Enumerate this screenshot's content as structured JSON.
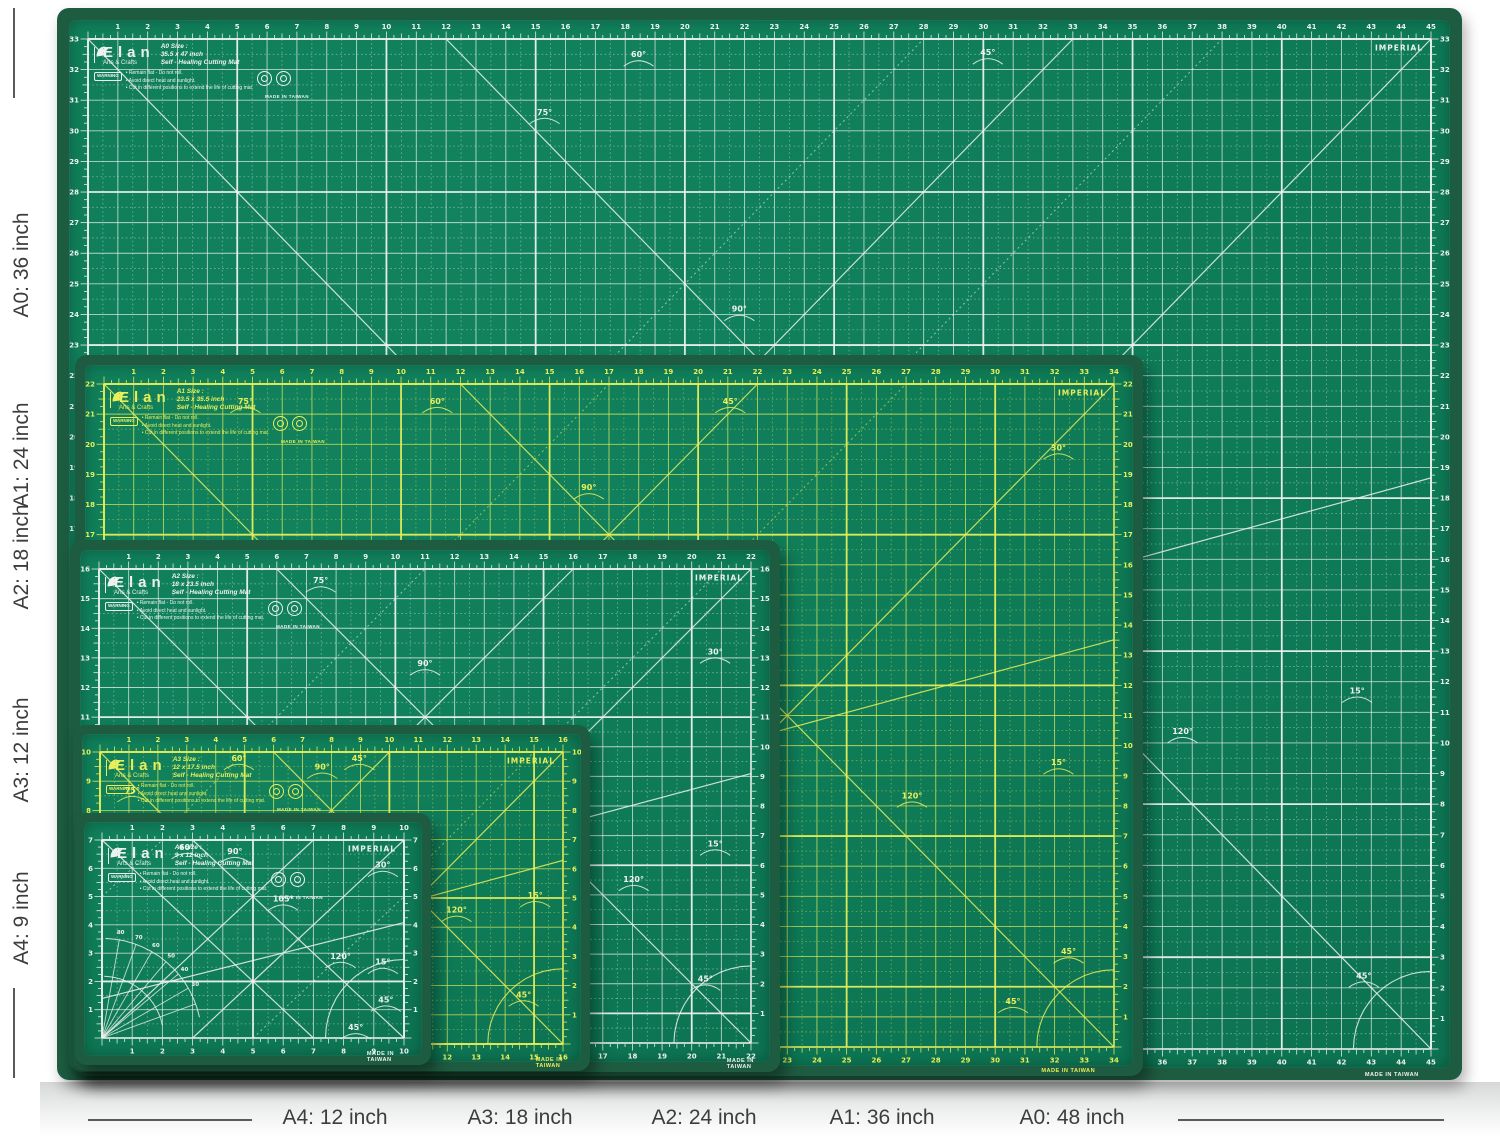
{
  "page": {
    "background": "#ffffff",
    "floor_top_px": 1082
  },
  "annotations": {
    "color": "#3d3d3d",
    "left_labels": [
      {
        "text": "A0: 36 inch",
        "cy": 265
      },
      {
        "text": "A1: 24 inch",
        "cy": 455
      },
      {
        "text": "A2: 18 inch",
        "cy": 557
      },
      {
        "text": "A3: 12 inch",
        "cy": 750
      },
      {
        "text": "A4: 9 inch",
        "cy": 918
      }
    ],
    "left_line_x": 13,
    "left_line_segments": [
      [
        8,
        98
      ],
      [
        988,
        1078
      ]
    ],
    "bottom_labels": [
      {
        "text": "A4: 12 inch",
        "cx": 335
      },
      {
        "text": "A3: 18 inch",
        "cx": 520
      },
      {
        "text": "A2: 24 inch",
        "cx": 704
      },
      {
        "text": "A1: 36 inch",
        "cx": 882
      },
      {
        "text": "A0: 48 inch",
        "cx": 1072
      }
    ],
    "bottom_line_y": 1119,
    "bottom_line_segments": [
      [
        88,
        252
      ],
      [
        1178,
        1444
      ]
    ]
  },
  "shared": {
    "edge_color": "#1e5c41",
    "surface_color_a": "#12835e",
    "surface_color_b": "#0c7050",
    "imperial": "IMPERIAL",
    "made_in": "MADE IN TAIWAN",
    "brand": "Elan",
    "brand_sub": "Arts & Crafts",
    "product": "Self - Healing Cutting Mat",
    "warning": "WARNING",
    "bullets": [
      "Remain flat - Do not roll.",
      "Avoid direct heat and sunlight.",
      "Cut in different positions to extend the life of cutting mat."
    ]
  },
  "mats": [
    {
      "id": "a0",
      "size_title": "A0 Size :",
      "size_text": "35.5 x 47 inch",
      "rect": [
        57,
        8,
        1405,
        1072
      ],
      "border": 12,
      "band": 19,
      "cols": 45,
      "rows": 33,
      "line": "#eef2ee",
      "made_x": 0.95,
      "protractor": false,
      "angles": [
        [
          "75°",
          0.34,
          0.075
        ],
        [
          "60°",
          0.41,
          0.018
        ],
        [
          "45°",
          0.67,
          0.016
        ],
        [
          "90°",
          0.485,
          0.27
        ],
        [
          "120°",
          0.815,
          0.688
        ],
        [
          "15°",
          0.945,
          0.648
        ],
        [
          "45°",
          0.95,
          0.93
        ]
      ]
    },
    {
      "id": "a1",
      "size_title": "A1 Size :",
      "size_text": "23.5 x 35.5 inch",
      "rect": [
        75,
        355,
        1068,
        721
      ],
      "border": 10,
      "band": 19,
      "cols": 34,
      "rows": 22,
      "line": "#e8ef5a",
      "made_x": 0.93,
      "protractor": false,
      "angles": [
        [
          "75°",
          0.14,
          0.03
        ],
        [
          "60°",
          0.33,
          0.03
        ],
        [
          "45°",
          0.62,
          0.03
        ],
        [
          "90°",
          0.48,
          0.16
        ],
        [
          "30°",
          0.945,
          0.1
        ],
        [
          "120°",
          0.8,
          0.625
        ],
        [
          "15°",
          0.945,
          0.575
        ],
        [
          "45°",
          0.955,
          0.86
        ],
        [
          "45°",
          0.9,
          0.935
        ]
      ]
    },
    {
      "id": "a2",
      "size_title": "A2 Size :",
      "size_text": "18 x 23.5 inch",
      "rect": [
        70,
        540,
        710,
        532
      ],
      "border": 10,
      "band": 19,
      "cols": 22,
      "rows": 16,
      "line": "#eef2ee",
      "made_x": 0.95,
      "protractor": false,
      "angles": [
        [
          "75°",
          0.34,
          0.03
        ],
        [
          "90°",
          0.5,
          0.205
        ],
        [
          "30°",
          0.945,
          0.18
        ],
        [
          "120°",
          0.82,
          0.66
        ],
        [
          "15°",
          0.945,
          0.585
        ],
        [
          "45°",
          0.93,
          0.87
        ]
      ]
    },
    {
      "id": "a3",
      "size_title": "A3 Size :",
      "size_text": "12 x 17.5 inch",
      "rect": [
        73,
        725,
        517,
        346
      ],
      "border": 9,
      "band": 18,
      "cols": 16,
      "rows": 10,
      "line": "#e8ef5a",
      "made_x": 0.93,
      "protractor": false,
      "angles": [
        [
          "60°",
          0.3,
          0.03
        ],
        [
          "45°",
          0.56,
          0.03
        ],
        [
          "90°",
          0.48,
          0.06
        ],
        [
          "75°",
          0.07,
          0.14
        ],
        [
          "120°",
          0.77,
          0.55
        ],
        [
          "15°",
          0.94,
          0.5
        ],
        [
          "45°",
          0.915,
          0.84
        ]
      ]
    },
    {
      "id": "a4",
      "size_title": "A4 Size :",
      "size_text": "9 x 12 inch",
      "rect": [
        75,
        813,
        356,
        252
      ],
      "border": 9,
      "band": 18,
      "cols": 10,
      "rows": 7,
      "line": "#eef2ee",
      "made_x": 0.88,
      "protractor": true,
      "protractor_numbers": [
        80,
        70,
        60,
        50,
        40,
        30
      ],
      "angles": [
        [
          "90°",
          0.44,
          0.07
        ],
        [
          "60°",
          0.28,
          0.05
        ],
        [
          "30°",
          0.93,
          0.14
        ],
        [
          "105°",
          0.6,
          0.31
        ],
        [
          "120°",
          0.79,
          0.6
        ],
        [
          "15°",
          0.93,
          0.63
        ],
        [
          "45°",
          0.94,
          0.82
        ],
        [
          "45°",
          0.84,
          0.96
        ]
      ]
    }
  ]
}
